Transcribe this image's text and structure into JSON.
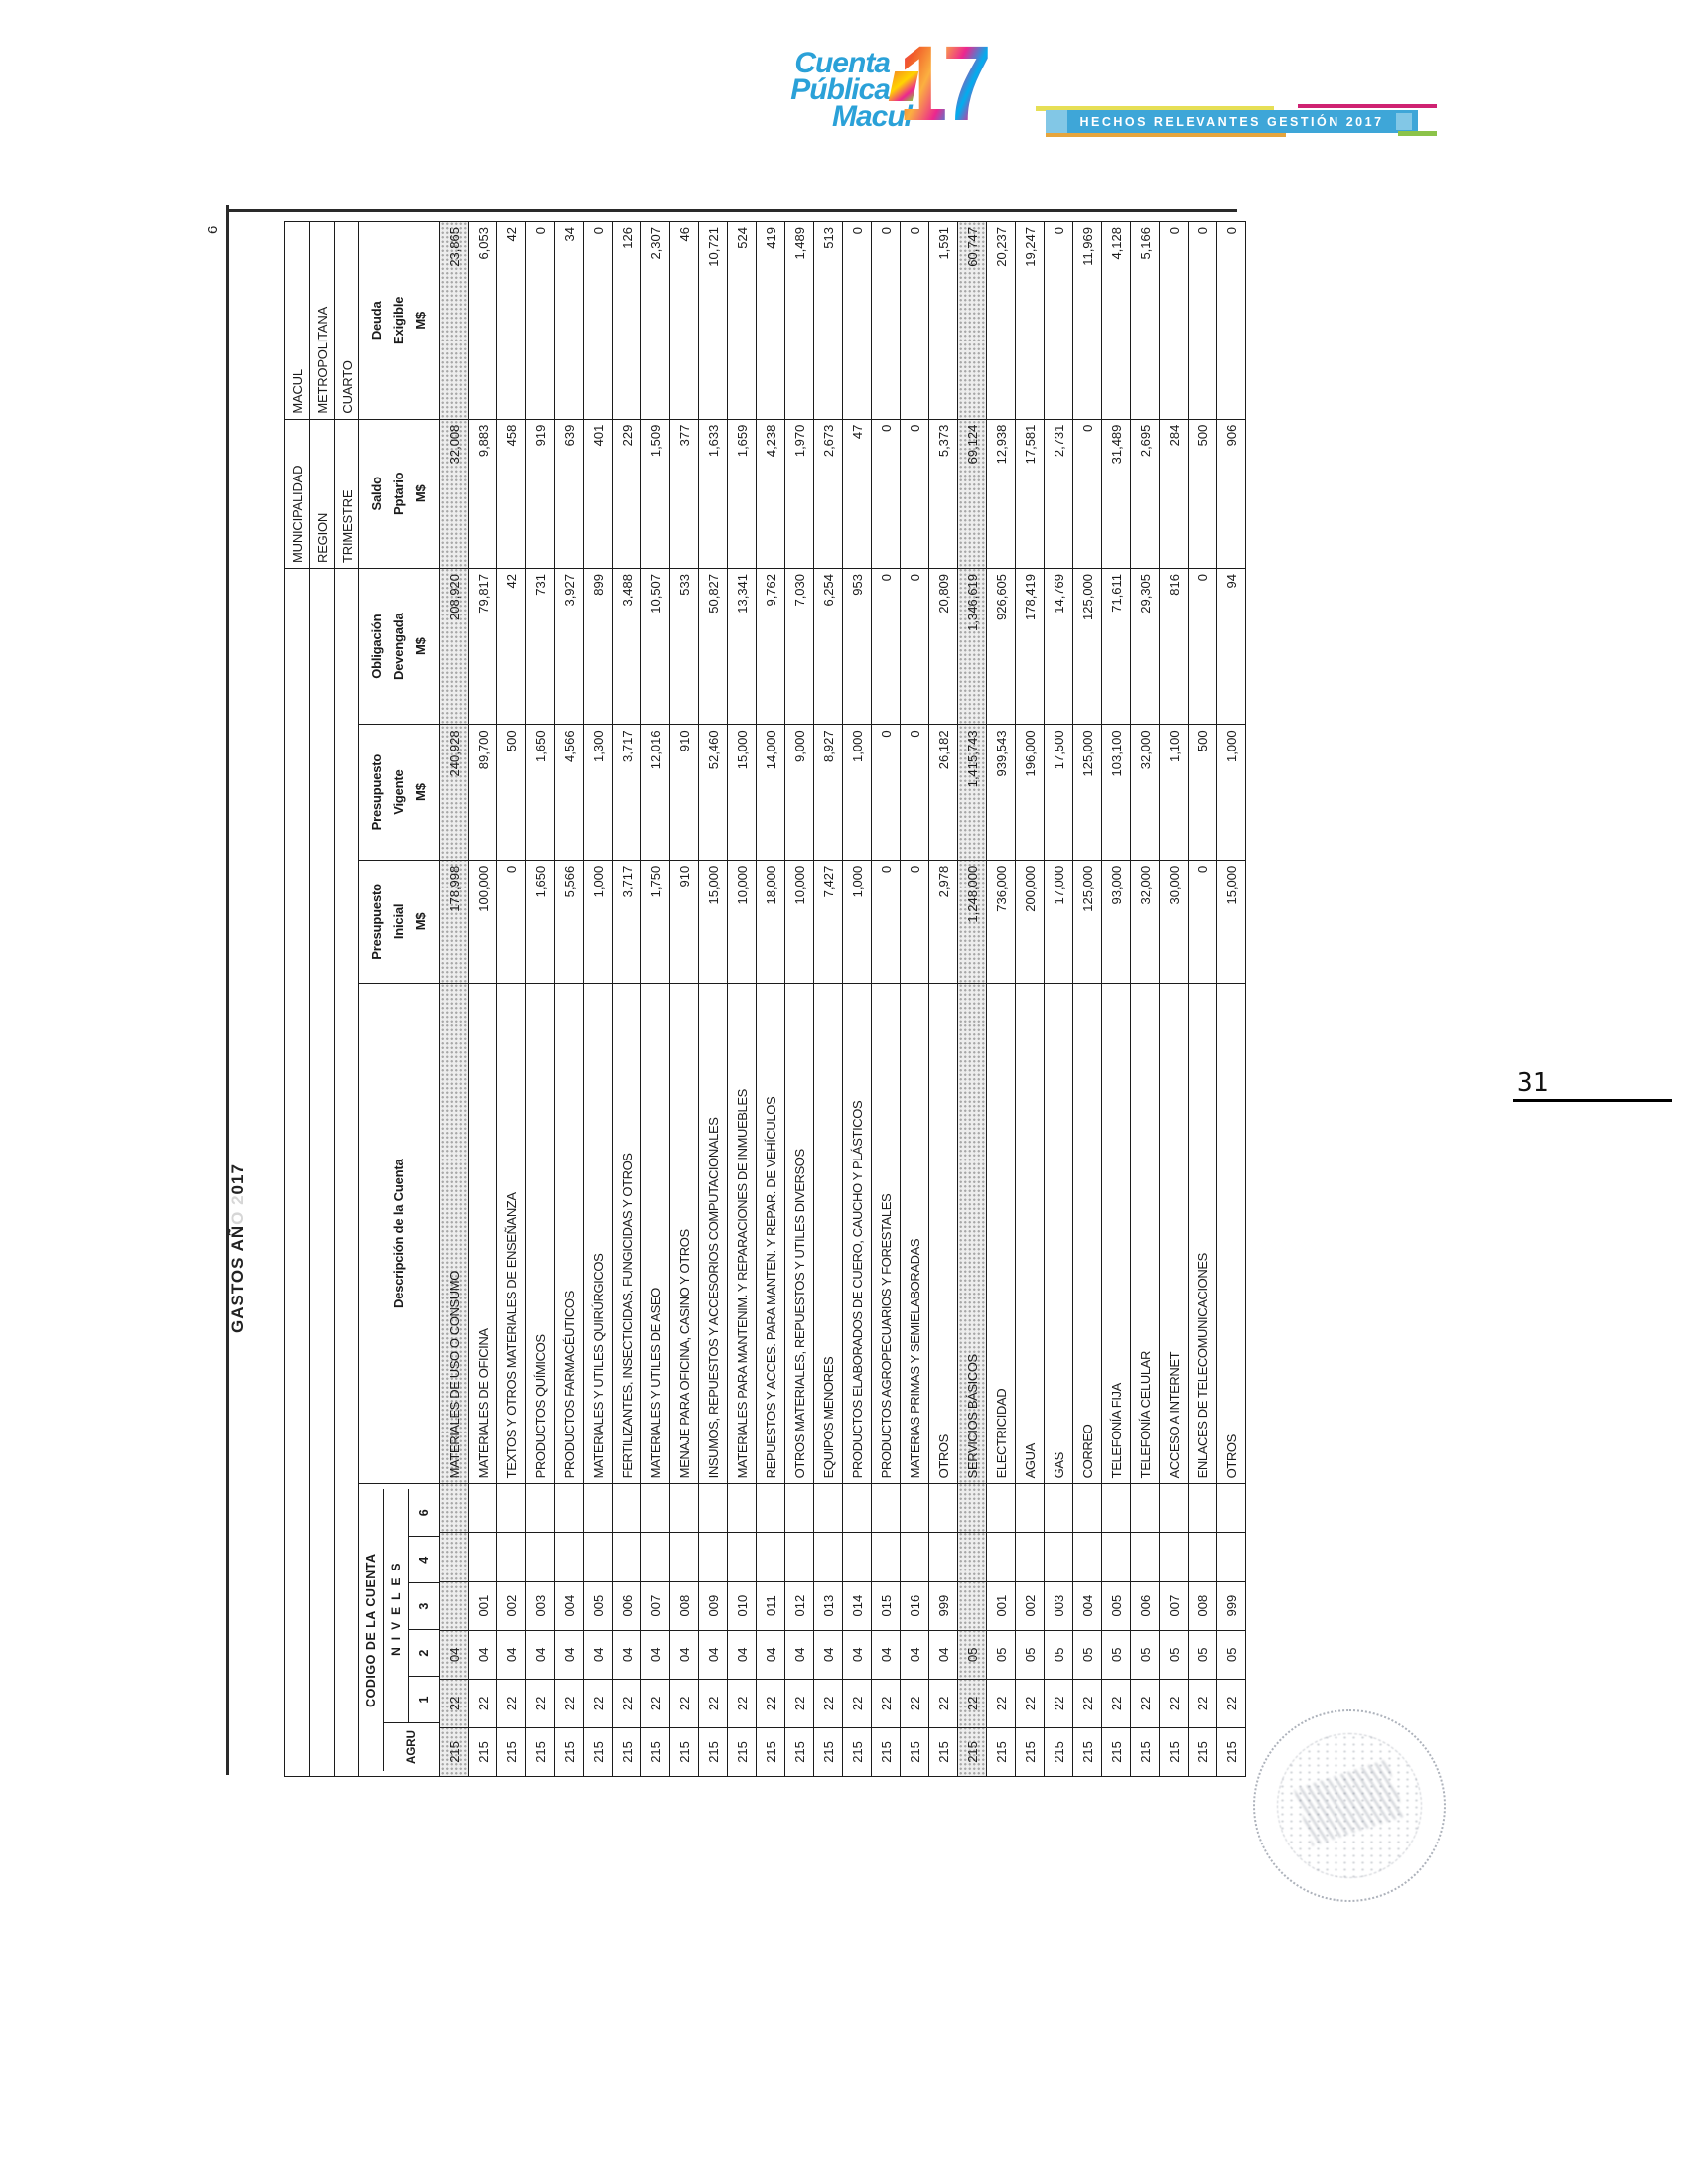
{
  "logo": {
    "line1": "Cuenta",
    "line2": "Pública",
    "line3": "Macul",
    "year": "17",
    "brand_blue": "#2ba1d8",
    "collage_colors": [
      "#ec268f",
      "#f15a29",
      "#fbb040",
      "#00aeef",
      "#8dc63f",
      "#ffd400"
    ]
  },
  "banner": {
    "text": "HECHOS RELEVANTES GESTIÓN 2017",
    "bar_color": "#3ea6d8",
    "accent_yellow": "#e6df55",
    "accent_magenta": "#cf2272",
    "accent_orange": "#e6a53d",
    "accent_green": "#8cc349"
  },
  "sheet": {
    "title_prefix": "GASTOS AÑ",
    "title_faded": "O 2",
    "title_suffix": "017",
    "title_full": "GASTOS AÑO 2017",
    "sheet_page_number": "6"
  },
  "meta": {
    "municipalidad_label": "MUNICIPALIDAD",
    "municipalidad_value": "MACUL",
    "region_label": "REGION",
    "region_value": "METROPOLITANA",
    "trimestre_label": "TRIMESTRE",
    "trimestre_value": "CUARTO"
  },
  "table": {
    "code_header": {
      "title": "CODIGO DE LA CUENTA",
      "niveles": "NIVELES",
      "levels": [
        "AGRU",
        "1",
        "2",
        "3",
        "4",
        "6"
      ]
    },
    "desc_header": "Descripción de la Cuenta",
    "col_headers": [
      [
        "Presupuesto",
        "Inicial",
        "M$"
      ],
      [
        "Presupuesto",
        "Vigente",
        "M$"
      ],
      [
        "Obligación",
        "Devengada",
        "M$"
      ],
      [
        "Saldo",
        "Pptario",
        "M$"
      ],
      [
        "Deuda",
        "Exigible",
        "M$"
      ]
    ],
    "rows": [
      {
        "agrup": "215",
        "n1": "22",
        "n2": "04",
        "n3": "",
        "desc": "MATERIALES DE USO O CONSUMO",
        "inicial": "178,998",
        "vigente": "240,928",
        "obligacion": "208,920",
        "saldo": "32,008",
        "deuda": "23,865",
        "shaded": true
      },
      {
        "agrup": "215",
        "n1": "22",
        "n2": "04",
        "n3": "001",
        "desc": "MATERIALES DE OFICINA",
        "inicial": "100,000",
        "vigente": "89,700",
        "obligacion": "79,817",
        "saldo": "9,883",
        "deuda": "6,053",
        "shaded": false
      },
      {
        "agrup": "215",
        "n1": "22",
        "n2": "04",
        "n3": "002",
        "desc": "TEXTOS Y OTROS MATERIALES DE ENSEÑANZA",
        "inicial": "0",
        "vigente": "500",
        "obligacion": "42",
        "saldo": "458",
        "deuda": "42",
        "shaded": false
      },
      {
        "agrup": "215",
        "n1": "22",
        "n2": "04",
        "n3": "003",
        "desc": "PRODUCTOS QUÍMICOS",
        "inicial": "1,650",
        "vigente": "1,650",
        "obligacion": "731",
        "saldo": "919",
        "deuda": "0",
        "shaded": false
      },
      {
        "agrup": "215",
        "n1": "22",
        "n2": "04",
        "n3": "004",
        "desc": "PRODUCTOS FARMACÉUTICOS",
        "inicial": "5,566",
        "vigente": "4,566",
        "obligacion": "3,927",
        "saldo": "639",
        "deuda": "34",
        "shaded": false
      },
      {
        "agrup": "215",
        "n1": "22",
        "n2": "04",
        "n3": "005",
        "desc": "MATERIALES Y UTILES QUIRÚRGICOS",
        "inicial": "1,000",
        "vigente": "1,300",
        "obligacion": "899",
        "saldo": "401",
        "deuda": "0",
        "shaded": false
      },
      {
        "agrup": "215",
        "n1": "22",
        "n2": "04",
        "n3": "006",
        "desc": "FERTILIZANTES, INSECTICIDAS, FUNGICIDAS Y OTROS",
        "inicial": "3,717",
        "vigente": "3,717",
        "obligacion": "3,488",
        "saldo": "229",
        "deuda": "126",
        "shaded": false
      },
      {
        "agrup": "215",
        "n1": "22",
        "n2": "04",
        "n3": "007",
        "desc": "MATERIALES Y UTILES DE ASEO",
        "inicial": "1,750",
        "vigente": "12,016",
        "obligacion": "10,507",
        "saldo": "1,509",
        "deuda": "2,307",
        "shaded": false
      },
      {
        "agrup": "215",
        "n1": "22",
        "n2": "04",
        "n3": "008",
        "desc": "MENAJE PARA OFICINA, CASINO Y OTROS",
        "inicial": "910",
        "vigente": "910",
        "obligacion": "533",
        "saldo": "377",
        "deuda": "46",
        "shaded": false
      },
      {
        "agrup": "215",
        "n1": "22",
        "n2": "04",
        "n3": "009",
        "desc": "INSUMOS, REPUESTOS Y ACCESORIOS COMPUTACIONALES",
        "inicial": "15,000",
        "vigente": "52,460",
        "obligacion": "50,827",
        "saldo": "1,633",
        "deuda": "10,721",
        "shaded": false
      },
      {
        "agrup": "215",
        "n1": "22",
        "n2": "04",
        "n3": "010",
        "desc": "MATERIALES PARA MANTENIM. Y REPARACIONES DE INMUEBLES",
        "inicial": "10,000",
        "vigente": "15,000",
        "obligacion": "13,341",
        "saldo": "1,659",
        "deuda": "524",
        "shaded": false
      },
      {
        "agrup": "215",
        "n1": "22",
        "n2": "04",
        "n3": "011",
        "desc": "REPUESTOS Y ACCES. PARA MANTEN. Y REPAR. DE VEHÍCULOS",
        "inicial": "18,000",
        "vigente": "14,000",
        "obligacion": "9,762",
        "saldo": "4,238",
        "deuda": "419",
        "shaded": false
      },
      {
        "agrup": "215",
        "n1": "22",
        "n2": "04",
        "n3": "012",
        "desc": "OTROS MATERIALES, REPUESTOS Y UTILES DIVERSOS",
        "inicial": "10,000",
        "vigente": "9,000",
        "obligacion": "7,030",
        "saldo": "1,970",
        "deuda": "1,489",
        "shaded": false
      },
      {
        "agrup": "215",
        "n1": "22",
        "n2": "04",
        "n3": "013",
        "desc": "EQUIPOS MENORES",
        "inicial": "7,427",
        "vigente": "8,927",
        "obligacion": "6,254",
        "saldo": "2,673",
        "deuda": "513",
        "shaded": false
      },
      {
        "agrup": "215",
        "n1": "22",
        "n2": "04",
        "n3": "014",
        "desc": "PRODUCTOS ELABORADOS DE CUERO, CAUCHO Y PLÁSTICOS",
        "inicial": "1,000",
        "vigente": "1,000",
        "obligacion": "953",
        "saldo": "47",
        "deuda": "0",
        "shaded": false
      },
      {
        "agrup": "215",
        "n1": "22",
        "n2": "04",
        "n3": "015",
        "desc": "PRODUCTOS AGROPECUARIOS Y FORESTALES",
        "inicial": "0",
        "vigente": "0",
        "obligacion": "0",
        "saldo": "0",
        "deuda": "0",
        "shaded": false
      },
      {
        "agrup": "215",
        "n1": "22",
        "n2": "04",
        "n3": "016",
        "desc": "MATERIAS PRIMAS Y SEMIELABORADAS",
        "inicial": "0",
        "vigente": "0",
        "obligacion": "0",
        "saldo": "0",
        "deuda": "0",
        "shaded": false
      },
      {
        "agrup": "215",
        "n1": "22",
        "n2": "04",
        "n3": "999",
        "desc": "OTROS",
        "inicial": "2,978",
        "vigente": "26,182",
        "obligacion": "20,809",
        "saldo": "5,373",
        "deuda": "1,591",
        "shaded": false
      },
      {
        "agrup": "215",
        "n1": "22",
        "n2": "05",
        "n3": "",
        "desc": "SERVICIOS BÁSICOS",
        "inicial": "1,248,000",
        "vigente": "1,415,743",
        "obligacion": "1,346,619",
        "saldo": "69,124",
        "deuda": "60,747",
        "shaded": true
      },
      {
        "agrup": "215",
        "n1": "22",
        "n2": "05",
        "n3": "001",
        "desc": "ELECTRICIDAD",
        "inicial": "736,000",
        "vigente": "939,543",
        "obligacion": "926,605",
        "saldo": "12,938",
        "deuda": "20,237",
        "shaded": false
      },
      {
        "agrup": "215",
        "n1": "22",
        "n2": "05",
        "n3": "002",
        "desc": "AGUA",
        "inicial": "200,000",
        "vigente": "196,000",
        "obligacion": "178,419",
        "saldo": "17,581",
        "deuda": "19,247",
        "shaded": false
      },
      {
        "agrup": "215",
        "n1": "22",
        "n2": "05",
        "n3": "003",
        "desc": "GAS",
        "inicial": "17,000",
        "vigente": "17,500",
        "obligacion": "14,769",
        "saldo": "2,731",
        "deuda": "0",
        "shaded": false
      },
      {
        "agrup": "215",
        "n1": "22",
        "n2": "05",
        "n3": "004",
        "desc": "CORREO",
        "inicial": "125,000",
        "vigente": "125,000",
        "obligacion": "125,000",
        "saldo": "0",
        "deuda": "11,969",
        "shaded": false
      },
      {
        "agrup": "215",
        "n1": "22",
        "n2": "05",
        "n3": "005",
        "desc": "TELEFONÍA FIJA",
        "inicial": "93,000",
        "vigente": "103,100",
        "obligacion": "71,611",
        "saldo": "31,489",
        "deuda": "4,128",
        "shaded": false
      },
      {
        "agrup": "215",
        "n1": "22",
        "n2": "05",
        "n3": "006",
        "desc": "TELEFONÍA CELULAR",
        "inicial": "32,000",
        "vigente": "32,000",
        "obligacion": "29,305",
        "saldo": "2,695",
        "deuda": "5,166",
        "shaded": false
      },
      {
        "agrup": "215",
        "n1": "22",
        "n2": "05",
        "n3": "007",
        "desc": "ACCESO A INTERNET",
        "inicial": "30,000",
        "vigente": "1,100",
        "obligacion": "816",
        "saldo": "284",
        "deuda": "0",
        "shaded": false
      },
      {
        "agrup": "215",
        "n1": "22",
        "n2": "05",
        "n3": "008",
        "desc": "ENLACES DE TELECOMUNICACIONES",
        "inicial": "0",
        "vigente": "500",
        "obligacion": "0",
        "saldo": "500",
        "deuda": "0",
        "shaded": false
      },
      {
        "agrup": "215",
        "n1": "22",
        "n2": "05",
        "n3": "999",
        "desc": "OTROS",
        "inicial": "15,000",
        "vigente": "1,000",
        "obligacion": "94",
        "saldo": "906",
        "deuda": "0",
        "shaded": false
      }
    ]
  },
  "footer": {
    "page_number": "31"
  }
}
